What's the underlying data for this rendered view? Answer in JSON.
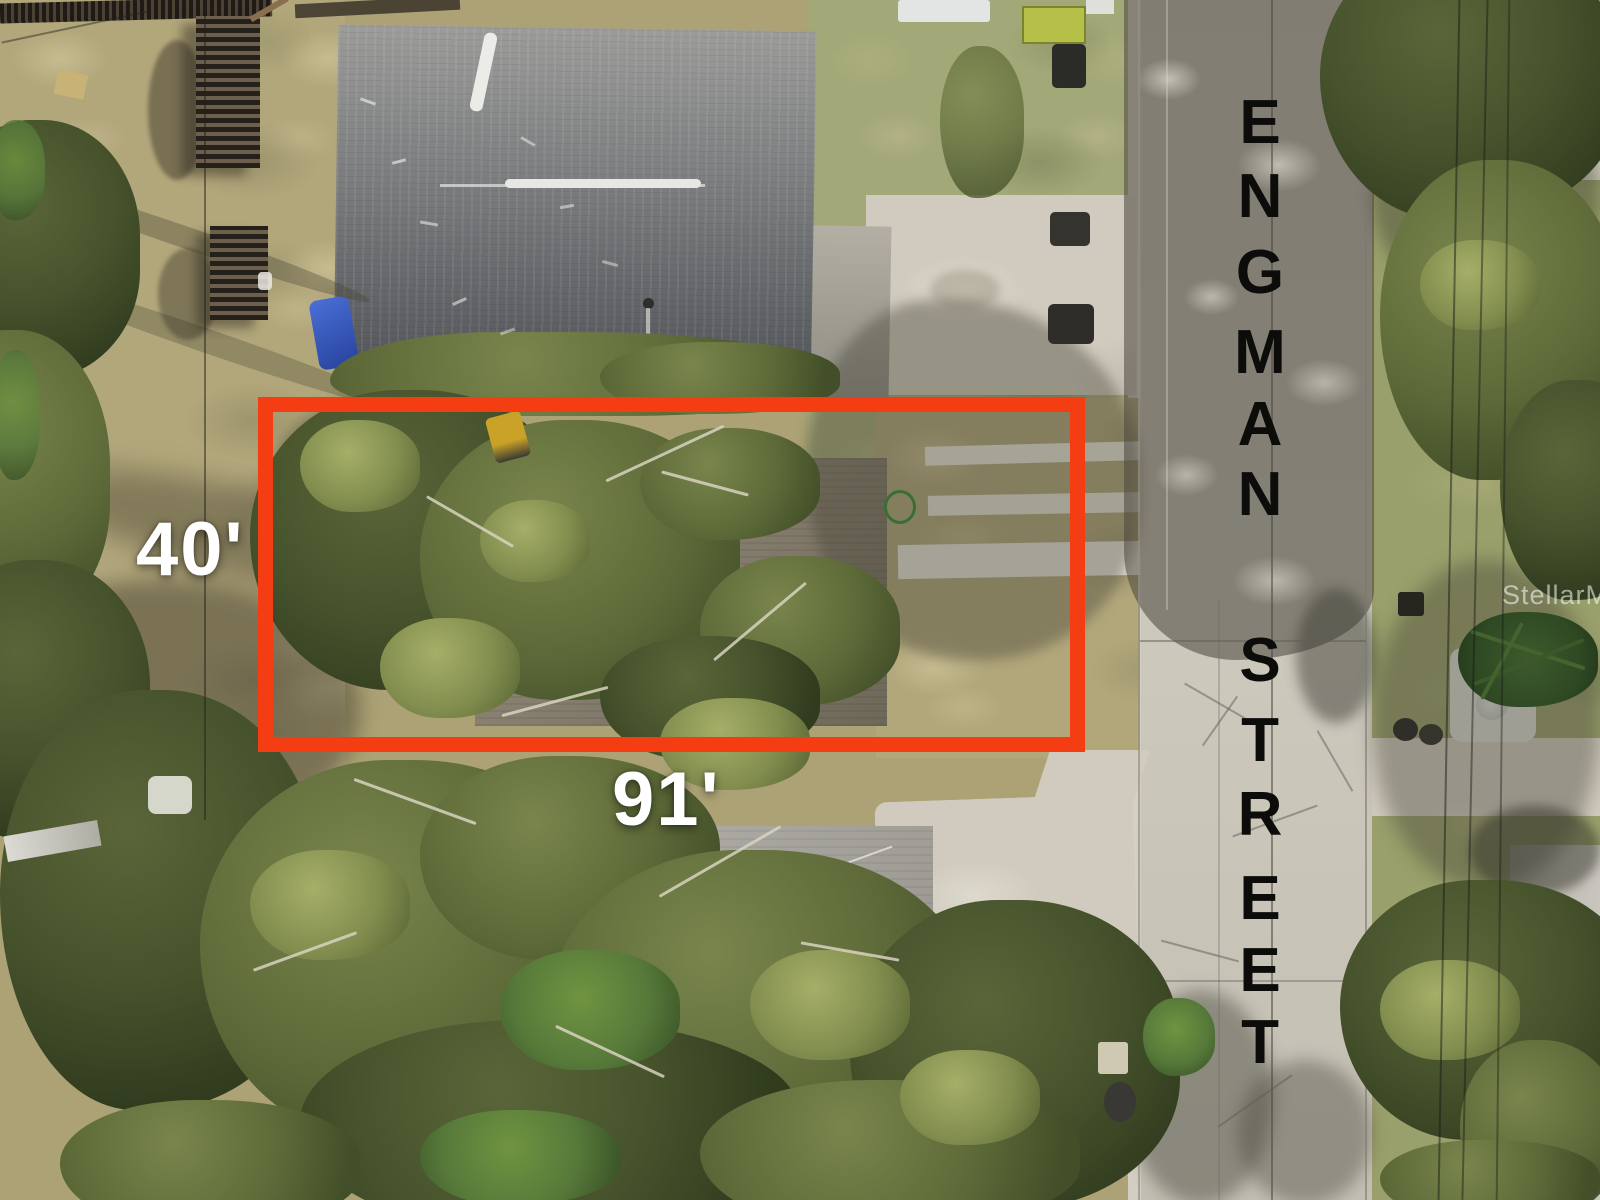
{
  "annotations": {
    "lot_width": "40'",
    "lot_depth": "91'",
    "watermark": "StellarMLS"
  },
  "street": {
    "name": "ENGMAN STREET",
    "letters": [
      "E",
      "N",
      "G",
      "M",
      "A",
      "N",
      "S",
      "T",
      "R",
      "E",
      "E",
      "T"
    ]
  },
  "colors": {
    "boundary_red": "#f43d12",
    "dimension_label_white": "#ffffff",
    "street_letter_black": "#0c0c0a"
  }
}
